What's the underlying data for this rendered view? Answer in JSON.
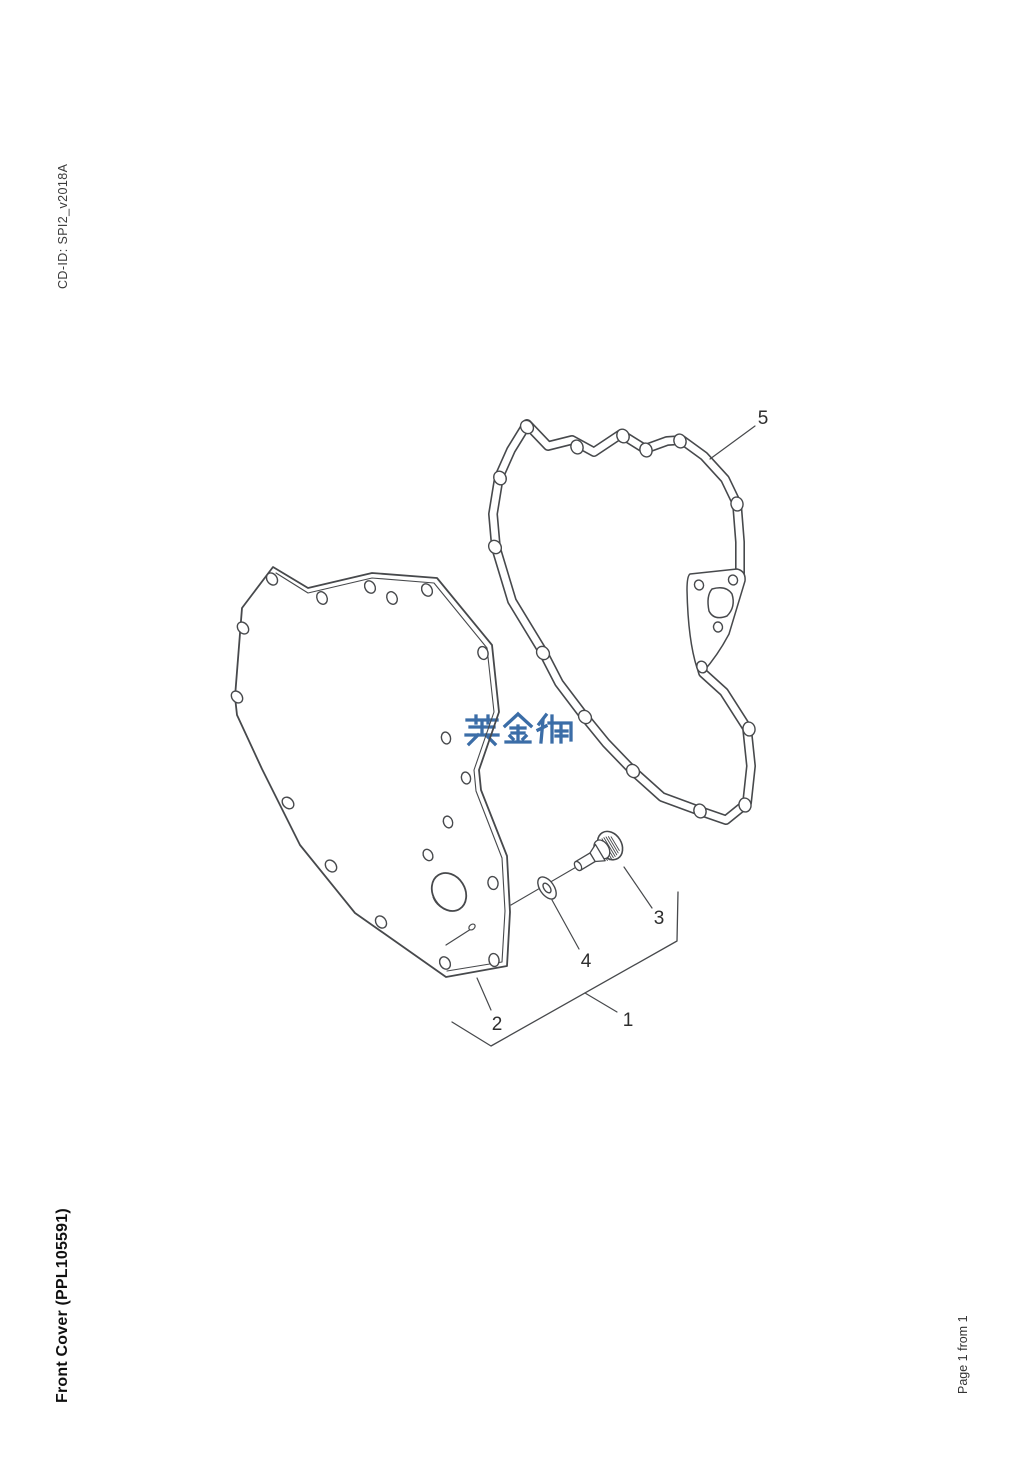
{
  "page": {
    "cd_id_label": "CD-ID: SPI2_v2018A",
    "title_label": "Front Cover (PPL105591)",
    "page_indicator_label": "Page 1 from 1",
    "background_color": "#ffffff"
  },
  "watermark": {
    "text": "英金狮",
    "color": "#3b6da7"
  },
  "diagram": {
    "line_color": "#47494c",
    "callouts": [
      {
        "label": "1"
      },
      {
        "label": "2"
      },
      {
        "label": "3"
      },
      {
        "label": "4"
      },
      {
        "label": "5"
      }
    ]
  }
}
